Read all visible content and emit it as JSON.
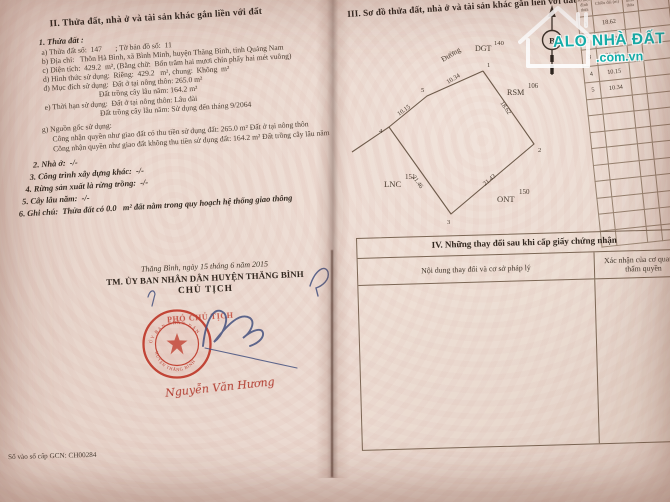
{
  "watermark": {
    "brand": "ALO NHÀ ĐẤT",
    "domain": ".com.vn",
    "color": "#12b1ad"
  },
  "left_page": {
    "section2_title": "II. Thửa đất, nhà ở và tài sản khác gắn liền với đất",
    "plot_heading": "1. Thửa đất :",
    "line_a": "a) Thửa đất số:  147       ; Tờ bản đồ số:  11",
    "line_b": "b) Địa chỉ:   Thôn Hà Bình, xã Bình Minh, huyện Thăng Bình, tỉnh Quảng Nam",
    "line_c": "c) Diện tích:  429.2  m², (Bằng chữ:  Bốn trăm hai mươi chín phẩy hai mét vuông)",
    "line_d": "d) Hình thức sử dụng:  Riêng:  429.2   m², chung:  Không  m²",
    "line_dd": "đ) Mục đích sử dụng:  Đất ở tại nông thôn: 265.0 m²",
    "line_dd2": "Đất trồng cây lâu năm: 164.2 m²",
    "line_e": "e) Thời hạn sử dụng:  Đất ở tại nông thôn: Lâu dài",
    "line_e2": "Đất trồng cây lâu năm: Sử dụng đến tháng 9/2064",
    "line_g": "g) Nguồn gốc sử dụng:",
    "line_g1": "Công nhận quyền như giao đất có thu tiền sử dụng đất: 265.0 m² Đất ở tại nông thôn",
    "line_g2": "Công nhận quyền như giao đất không thu tiền sử dụng đất: 164.2 m² Đất trồng cây lâu năm",
    "item2": "2. Nhà ở:  -/-",
    "item3": "3. Công trình xây dựng khác:  -/-",
    "item4": "4. Rừng sản xuất là rừng trồng:  -/-",
    "item5": "5. Cây lâu năm:  -/-",
    "item6": "6. Ghi chú:  Thửa đất có 0.0   m² đất nằm trong quy hoạch hệ thống giao thông",
    "date_line": "Thăng Bình, ngày 15 tháng 6 năm 2015",
    "committee_line": "TM. ỦY BAN NHÂN DÂN HUYỆN THĂNG BÌNH",
    "chairman_title": "CHỦ TỊCH",
    "stamp_ring_top": "ỦY BAN NHÂN DÂN",
    "stamp_ring_bottom": "HUYỆN THĂNG BÌNH",
    "deputy_title": "PHÓ CHỦ TỊCH",
    "signer_name": "Nguyễn Văn Hương",
    "book_entry": "Số vào sổ cấp GCN:   CH00284"
  },
  "right_page": {
    "section3_title": "III. Sơ đồ thửa đất, nhà ở và tài sản khác gắn liền với đất",
    "north_label": "B",
    "diagram": {
      "road_label": "Đường",
      "edge_top": "10.34",
      "edge_upper_left": "10.15",
      "edge_right": "18.62",
      "edge_lower_right": "21.43",
      "edge_lower_left": "21.46",
      "vertex_1": "1",
      "vertex_2": "2",
      "vertex_3": "3",
      "vertex_4": "4",
      "vertex_5": "5",
      "adj_top_code": "DGT",
      "adj_top_num": "140",
      "adj_right_code": "RSM",
      "adj_right_num": "106",
      "adj_left_code": "LNC",
      "adj_left_num": "151",
      "adj_bottom_code": "ONT",
      "adj_bottom_num": "150"
    },
    "length_table": {
      "header_vertex": "Số hiệu đỉnh thửa",
      "header_length": "Chiều dài (m)",
      "rows": [
        [
          "1",
          "18.62"
        ],
        [
          "2",
          "21.43"
        ],
        [
          "3",
          "21.46"
        ],
        [
          "4",
          "10.15"
        ],
        [
          "5",
          "10.34"
        ]
      ]
    },
    "section4_title": "IV. Những thay đổi sau khi cấp giấy chứng nhận",
    "change_col_header": "Nội dung thay đổi và cơ sở pháp lý",
    "confirm_col_header": "Xác nhận của cơ quan có thẩm quyền"
  }
}
